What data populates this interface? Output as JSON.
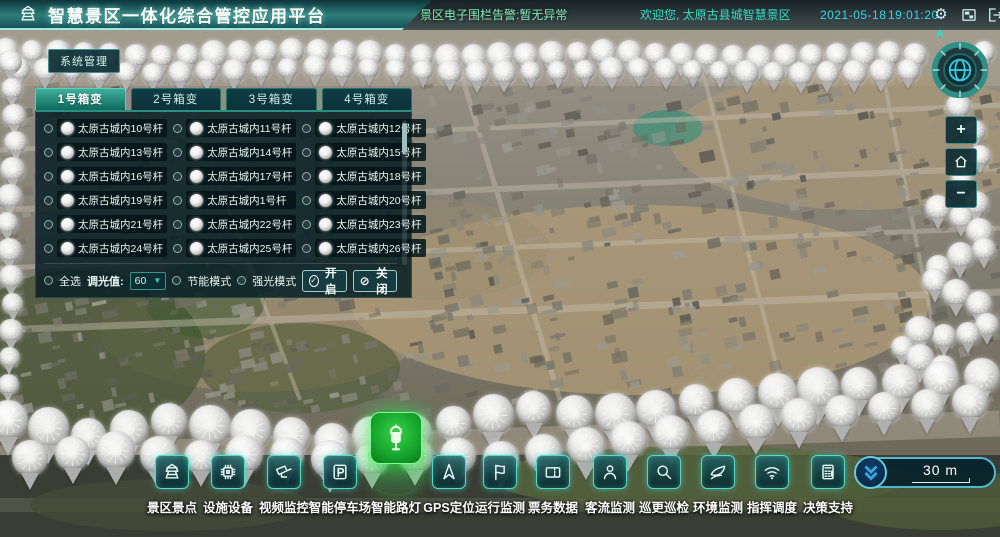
{
  "header": {
    "title": "智慧景区一体化综合管控应用平台",
    "alert_text": "景区电子围栏告警:暂无异常",
    "welcome_text": "欢迎您, 太原古县城智慧景区",
    "date": "2021-05-18",
    "time": "19:01:20",
    "gear_icon": "⚙"
  },
  "system_button": {
    "label": "系统管理"
  },
  "panel": {
    "tabs": [
      {
        "label": "1号箱变",
        "active": true
      },
      {
        "label": "2号箱变",
        "active": false
      },
      {
        "label": "3号箱变",
        "active": false
      },
      {
        "label": "4号箱变",
        "active": false
      }
    ],
    "lamps": [
      "太原古城内10号杆",
      "太原古城内11号杆",
      "太原古城内12号杆",
      "太原古城内13号杆",
      "太原古城内14号杆",
      "太原古城内15号杆",
      "太原古城内16号杆",
      "太原古城内17号杆",
      "太原古城内18号杆",
      "太原古城内19号杆",
      "太原古城内1号杆",
      "太原古城内20号杆",
      "太原古城内21号杆",
      "太原古城内22号杆",
      "太原古城内23号杆",
      "太原古城内24号杆",
      "太原古城内25号杆",
      "太原古城内26号杆"
    ],
    "controls": {
      "select_all_label": "全选",
      "dim_label": "调光值:",
      "dim_value": "60",
      "mode1_label": "节能模式",
      "mode2_label": "强光模式",
      "open_label": "开启",
      "close_label": "关闭"
    }
  },
  "toolbar": {
    "items": [
      {
        "label": "景区景点",
        "icon": "pagoda-icon",
        "active": false
      },
      {
        "label": "设施设备",
        "icon": "chip-icon",
        "active": false
      },
      {
        "label": "视频监控",
        "icon": "cctv-icon",
        "active": false
      },
      {
        "label": "智能停车场",
        "icon": "parking-icon",
        "active": false
      },
      {
        "label": "智能路灯",
        "icon": "streetlamp-icon",
        "active": true
      },
      {
        "label": "GPS定位",
        "icon": "gps-icon",
        "active": false
      },
      {
        "label": "运行监测",
        "icon": "route-flag-icon",
        "active": false
      },
      {
        "label": "票务数据",
        "icon": "ticket-icon",
        "active": false
      },
      {
        "label": "客流监测",
        "icon": "visitor-icon",
        "active": false
      },
      {
        "label": "巡更巡检",
        "icon": "patrol-icon",
        "active": false
      },
      {
        "label": "环境监测",
        "icon": "environment-icon",
        "active": false
      },
      {
        "label": "指挥调度",
        "icon": "dispatch-icon",
        "active": false
      },
      {
        "label": "决策支持",
        "icon": "decision-icon",
        "active": false
      }
    ]
  },
  "map": {
    "compass_label": "N",
    "zoom_in_label": "+",
    "zoom_out_label": "−",
    "scale_label": "30 m",
    "marker_trails": [
      {
        "name": "top-row-a",
        "size": 25,
        "spacing": 26,
        "points": [
          [
            6,
            50
          ],
          [
            150,
            57
          ],
          [
            300,
            50
          ],
          [
            450,
            58
          ],
          [
            600,
            52
          ],
          [
            750,
            58
          ],
          [
            900,
            53
          ],
          [
            935,
            58
          ]
        ]
      },
      {
        "name": "top-row-b",
        "size": 23,
        "spacing": 27,
        "points": [
          [
            18,
            69
          ],
          [
            160,
            74
          ],
          [
            320,
            67
          ],
          [
            480,
            73
          ],
          [
            640,
            69
          ],
          [
            800,
            74
          ],
          [
            930,
            70
          ]
        ]
      },
      {
        "name": "left-column",
        "size": 23,
        "spacing": 27,
        "points": [
          [
            10,
            62
          ],
          [
            16,
            140
          ],
          [
            7,
            220
          ],
          [
            13,
            300
          ],
          [
            8,
            380
          ],
          [
            12,
            432
          ]
        ]
      },
      {
        "name": "right-edge",
        "size": 24,
        "spacing": 30,
        "points": [
          [
            984,
            52
          ],
          [
            958,
            105
          ],
          [
            986,
            148
          ],
          [
            960,
            182
          ],
          [
            984,
            214
          ]
        ]
      },
      {
        "name": "right-cluster",
        "size": 26,
        "spacing": 25,
        "points": [
          [
            938,
            208
          ],
          [
            974,
            222
          ],
          [
            990,
            248
          ],
          [
            952,
            258
          ],
          [
            926,
            276
          ],
          [
            954,
            292
          ],
          [
            984,
            306
          ],
          [
            988,
            330
          ],
          [
            950,
            338
          ],
          [
            918,
            330
          ],
          [
            900,
            350
          ],
          [
            928,
            362
          ],
          [
            955,
            372
          ]
        ]
      },
      {
        "name": "bottom-row-main",
        "size": 38,
        "spacing": 41,
        "points": [
          [
            8,
            420
          ],
          [
            90,
            436
          ],
          [
            170,
            421
          ],
          [
            250,
            430
          ],
          [
            330,
            441
          ],
          [
            410,
            433
          ],
          [
            470,
            419
          ],
          [
            530,
            408
          ],
          [
            590,
            416
          ],
          [
            650,
            411
          ],
          [
            710,
            399
          ],
          [
            770,
            393
          ],
          [
            830,
            387
          ],
          [
            890,
            383
          ],
          [
            950,
            378
          ],
          [
            995,
            375
          ]
        ]
      },
      {
        "name": "bottom-row-front",
        "size": 36,
        "spacing": 43,
        "points": [
          [
            30,
            458
          ],
          [
            110,
            450
          ],
          [
            190,
            458
          ],
          [
            270,
            452
          ],
          [
            350,
            461
          ],
          [
            430,
            454
          ],
          [
            510,
            459
          ],
          [
            570,
            448
          ],
          [
            630,
            439
          ],
          [
            690,
            431
          ],
          [
            750,
            423
          ],
          [
            810,
            415
          ],
          [
            870,
            409
          ],
          [
            930,
            405
          ],
          [
            988,
            401
          ]
        ]
      }
    ]
  },
  "colors": {
    "accent_teal": "#57d8cc",
    "accent_green": "#21c83a",
    "accent_cyan": "#3fd2e6",
    "alert_green": "#86e8b9",
    "header_gradient_top": "#0d353c",
    "header_gradient_mid": "#2e7d79",
    "scale_border_blue": "#4db8d0"
  }
}
